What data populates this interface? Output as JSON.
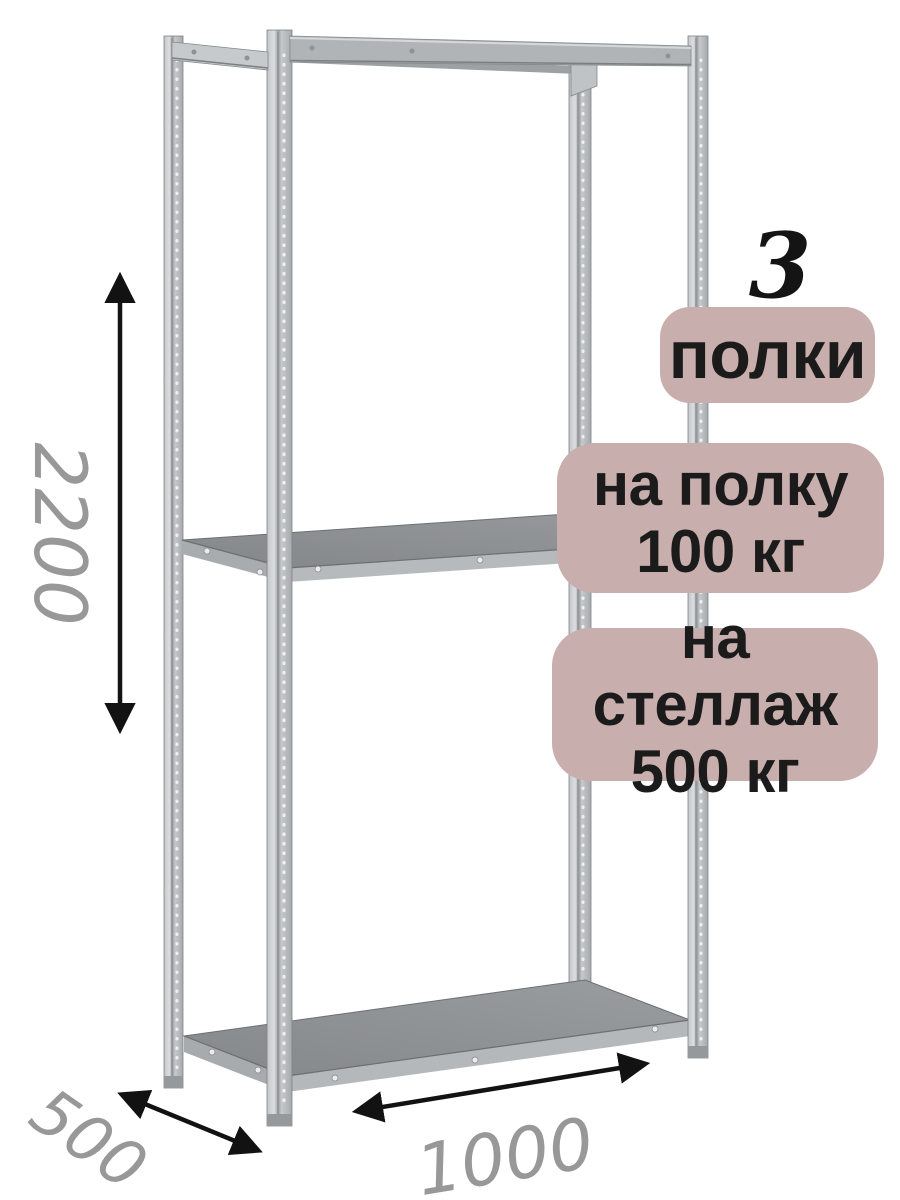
{
  "badges": {
    "shelf_count_number": "3",
    "shelf_count_label": "полки",
    "per_shelf": {
      "line1": "на полку",
      "line2": "100 кг"
    },
    "per_rack": {
      "line1": "на стеллаж",
      "line2": "500 кг"
    }
  },
  "dimensions": {
    "height": "2200",
    "depth": "500",
    "width": "1000"
  },
  "colors": {
    "badge_background": "#c8aeac",
    "badge_text": "#1b1b1b",
    "count_number_text": "#141414",
    "dimension_text": "#989898",
    "dimension_arrow": "#121212",
    "metal_light": "#d8dadc",
    "metal_mid": "#b1b4b7",
    "shelf_surface": "#8d9092",
    "background": "#ffffff"
  }
}
